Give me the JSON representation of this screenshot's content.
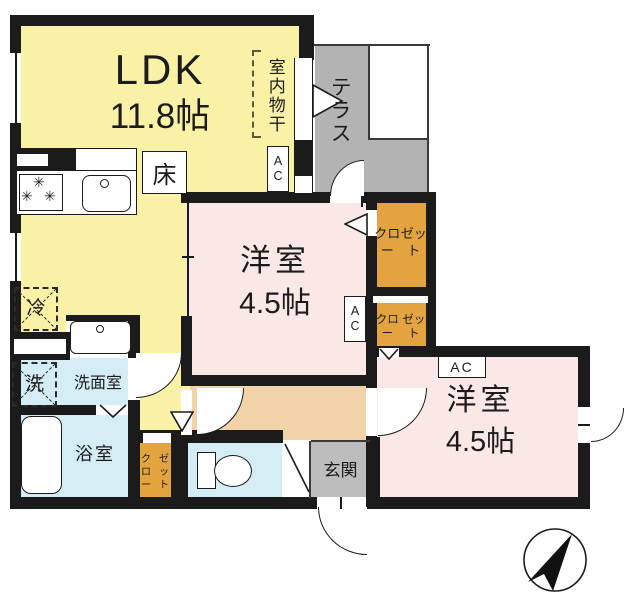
{
  "rooms": {
    "ldk": {
      "label": "LDK",
      "area": "11.8帖"
    },
    "bedroom1": {
      "label": "洋室",
      "area": "4.5帖"
    },
    "bedroom2": {
      "label": "洋室",
      "area": "4.5帖"
    },
    "terrace": {
      "label": "テラス"
    },
    "washroom": {
      "label": "洗面室"
    },
    "bathroom": {
      "label": "浴室"
    },
    "entrance": {
      "label": "玄関"
    }
  },
  "labels": {
    "indoor_drying": "室内物干",
    "floor": "床",
    "ac": "AC",
    "closet_line1": "クロー",
    "closet_line2": "ゼット",
    "fridge": "冷",
    "washer": "洗"
  },
  "colors": {
    "wall": "#1b1b1b",
    "ldk_yellow": "#F9F2A6",
    "bedroom_pink": "#F9E8E6",
    "hall_peach": "#F2D2A8",
    "closet_orange": "#E3A33E",
    "terrace_gray": "#B3B3B3",
    "entrance_gray": "#BDBDBD",
    "wet_blue": "#D4EDF4"
  }
}
